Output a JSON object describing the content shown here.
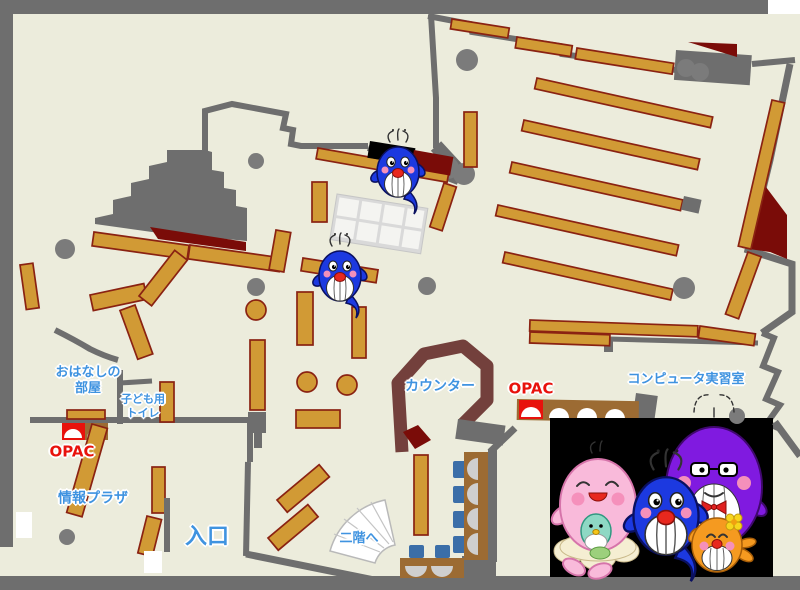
{
  "title": "library-first-floor-map",
  "colors": {
    "floor": "#ececdc",
    "wall": "#6e6e6e",
    "shelf": "#d19a35",
    "shelf_border": "#8a2212",
    "dark_red": "#7a0c08",
    "counter": "#73403c",
    "label_blue": "#3f93e0",
    "label_red": "#e8120c",
    "chair_blue": "#3b6ea8",
    "desk_brown": "#9c6b33",
    "pillar": "#7b7b7b",
    "photo_bg": "#000000",
    "whale_blue": "#1c39e0",
    "whale_pink": "#f9bada",
    "whale_purple": "#801ae0",
    "whale_orange": "#f59a20",
    "whale_teal": "#8ed8c4"
  },
  "labels": {
    "storytime_room": {
      "line1": "おはなしの",
      "line2": "部屋"
    },
    "kids_toilet": {
      "line1": "子ども用",
      "line2": "トイレ"
    },
    "opac_left": "OPAC",
    "info_plaza": "情報プラザ",
    "entrance": "入口",
    "counter": "カウンター",
    "opac_right": "OPAC",
    "computer_room": "コンピュータ実習室",
    "stairs_up": "二階へ"
  },
  "mascots": {
    "floor_whales": [
      "blue-whale-child",
      "blue-whale-child"
    ],
    "family_photo": [
      "pink-whale-mother",
      "teal-whale-baby",
      "blue-whale-child",
      "purple-whale-father",
      "orange-whale-sister"
    ]
  }
}
